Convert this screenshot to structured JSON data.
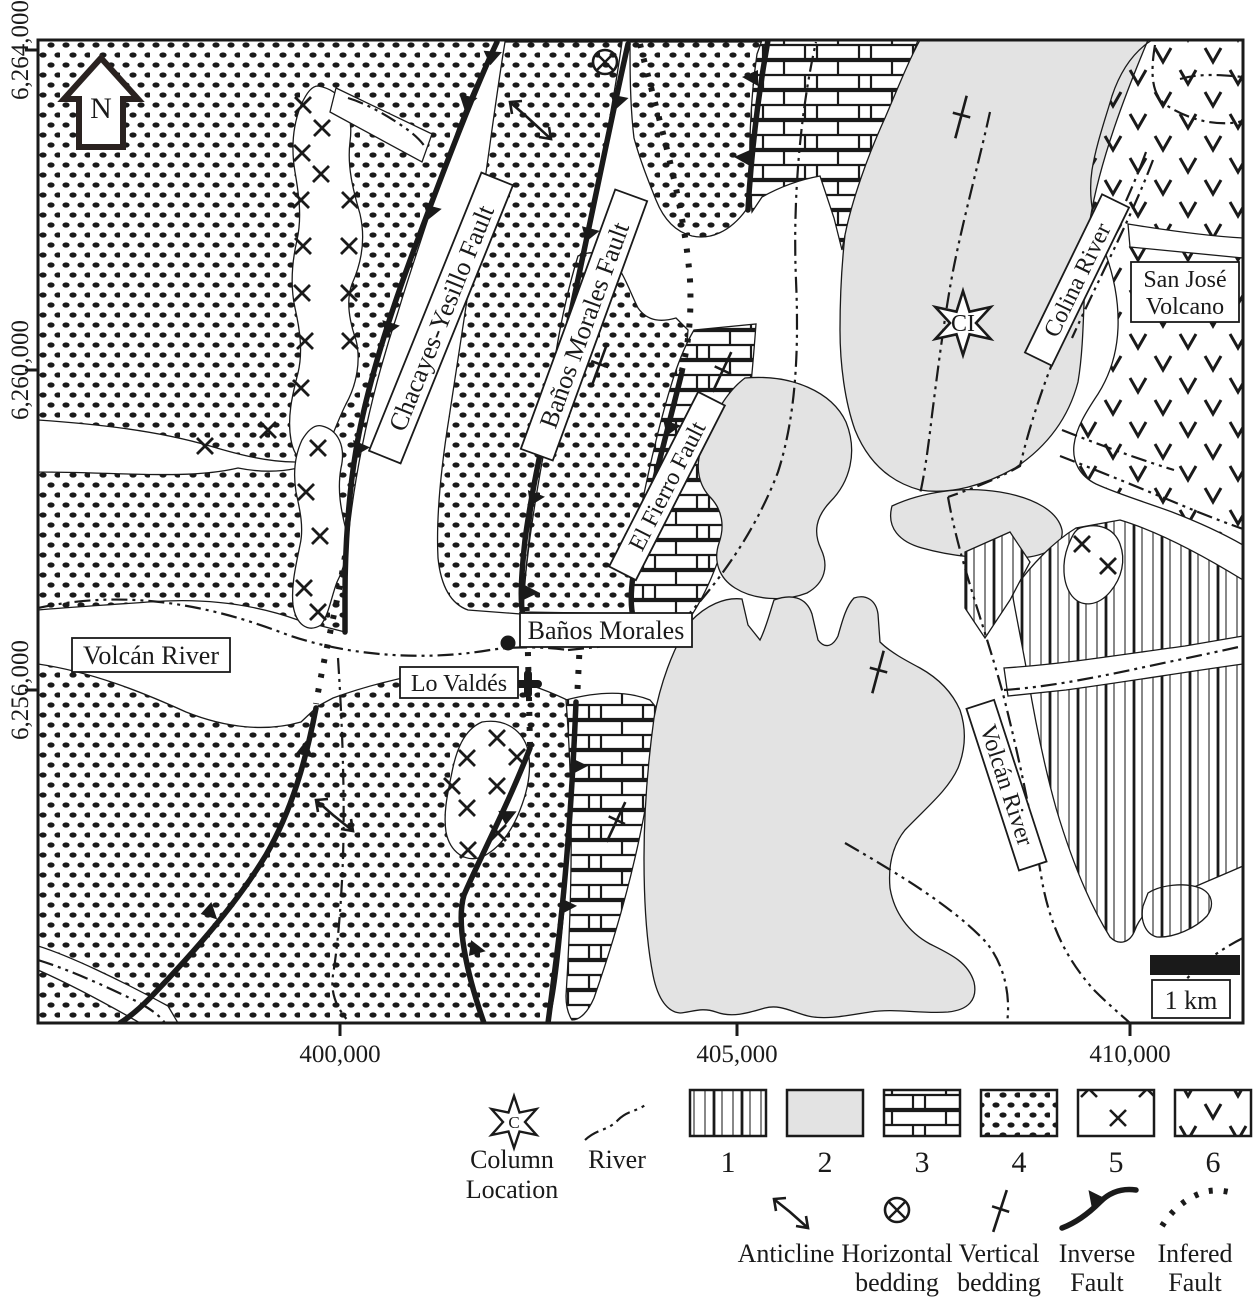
{
  "colors": {
    "ink": "#1a1a1a",
    "unit2_gray": "#e3e3e3",
    "paper": "#ffffff"
  },
  "axes": {
    "y_ticks": [
      "6,264,000",
      "6,260,000",
      "6,256,000"
    ],
    "x_ticks": [
      "400,000",
      "405,000",
      "410,000"
    ]
  },
  "north": {
    "label": "N"
  },
  "map_labels": {
    "volcan_river_west": "Volcán River",
    "banos_morales_town": "Baños Morales",
    "lo_valdes": "Lo Valdés",
    "chacayes_fault": "Chacayes-Yesillo Fault",
    "banos_morales_fault": "Baños Morales Fault",
    "el_fierro_fault": "El Fierro Fault",
    "colina_river": "Colina River",
    "volcan_river_east": "Volcán River",
    "san_jose_volcano_line1": "San José",
    "san_jose_volcano_line2": "Volcano",
    "column_star_text": "CI"
  },
  "scale_bar": {
    "label": "1 km"
  },
  "legend": {
    "column_location": {
      "star_letter": "C",
      "label_line1": "Column",
      "label_line2": "Location"
    },
    "river_label": "River",
    "unit_numbers": [
      "1",
      "2",
      "3",
      "4",
      "5",
      "6"
    ],
    "anticline": "Anticline",
    "horizontal_bedding_line1": "Horizontal",
    "horizontal_bedding_line2": "bedding",
    "vertical_bedding_line1": "Vertical",
    "vertical_bedding_line2": "bedding",
    "inverse_fault_line1": "Inverse",
    "inverse_fault_line2": "Fault",
    "infered_fault_line1": "Infered",
    "infered_fault_line2": "Fault"
  }
}
